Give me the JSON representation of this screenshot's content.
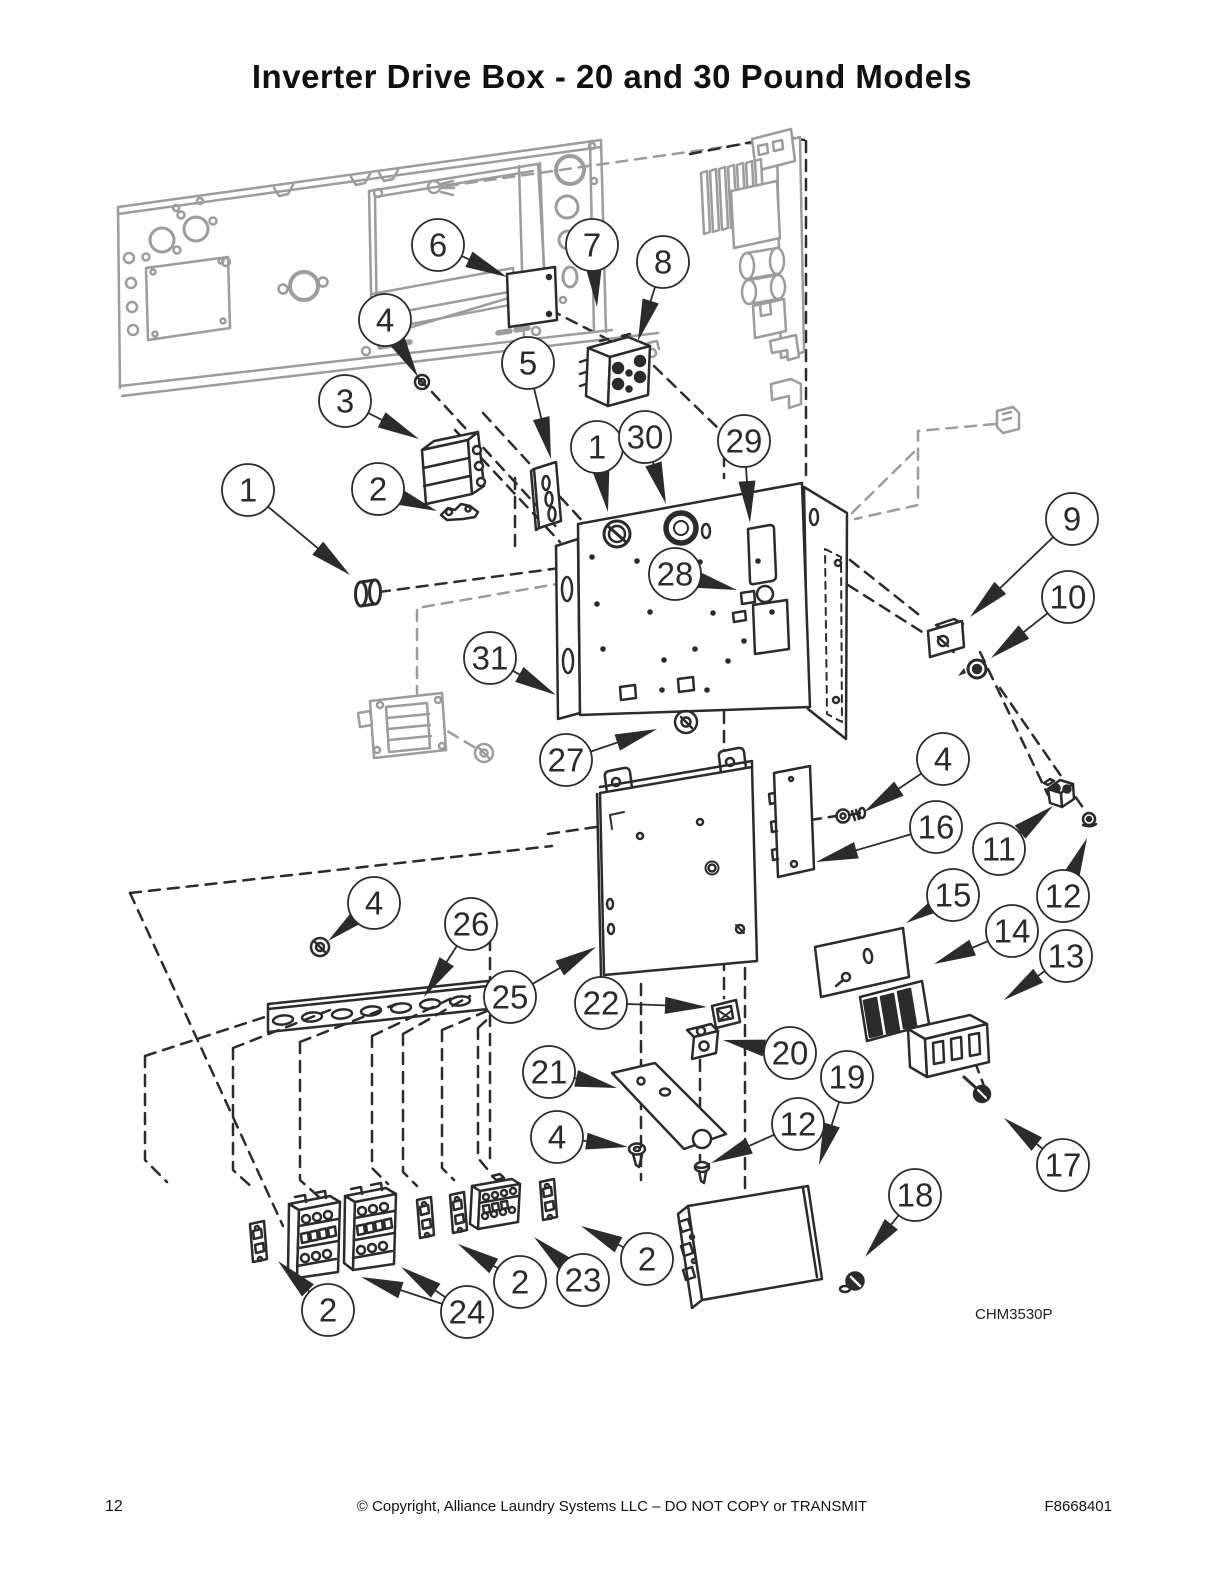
{
  "title": "Inverter Drive Box - 20 and 30 Pound Models",
  "diagram": {
    "figure_code": "CHM3530P",
    "callout_radius": 26,
    "callouts": [
      {
        "n": "6",
        "c": [
          438,
          245
        ],
        "tips": [
          [
            507,
            277
          ]
        ]
      },
      {
        "n": "7",
        "c": [
          592,
          245
        ],
        "tips": [
          [
            597,
            307
          ]
        ]
      },
      {
        "n": "8",
        "c": [
          663,
          262
        ],
        "tips": [
          [
            638,
            341
          ]
        ]
      },
      {
        "n": "4",
        "c": [
          385,
          320
        ],
        "tips": [
          [
            418,
            377
          ]
        ]
      },
      {
        "n": "5",
        "c": [
          528,
          363
        ],
        "tips": [
          [
            551,
            459
          ]
        ]
      },
      {
        "n": "3",
        "c": [
          345,
          401
        ],
        "tips": [
          [
            419,
            439
          ]
        ]
      },
      {
        "n": "1",
        "c": [
          597,
          447
        ],
        "tips": [
          [
            608,
            512
          ]
        ]
      },
      {
        "n": "30",
        "c": [
          645,
          437
        ],
        "tips": [
          [
            666,
            504
          ]
        ]
      },
      {
        "n": "29",
        "c": [
          744,
          441
        ],
        "tips": [
          [
            750,
            523
          ]
        ]
      },
      {
        "n": "2",
        "c": [
          378,
          489
        ],
        "tips": [
          [
            437,
            511
          ]
        ]
      },
      {
        "n": "1",
        "c": [
          248,
          490
        ],
        "tips": [
          [
            350,
            575
          ]
        ]
      },
      {
        "n": "9",
        "c": [
          1072,
          519
        ],
        "tips": [
          [
            970,
            617
          ]
        ]
      },
      {
        "n": "10",
        "c": [
          1068,
          597
        ],
        "tips": [
          [
            991,
            658
          ]
        ]
      },
      {
        "n": "28",
        "c": [
          675,
          574
        ],
        "tips": [
          [
            737,
            590
          ]
        ]
      },
      {
        "n": "31",
        "c": [
          490,
          658
        ],
        "tips": [
          [
            556,
            695
          ]
        ]
      },
      {
        "n": "27",
        "c": [
          566,
          760
        ],
        "tips": [
          [
            657,
            729
          ]
        ]
      },
      {
        "n": "4",
        "c": [
          943,
          759
        ],
        "tips": [
          [
            864,
            812
          ]
        ]
      },
      {
        "n": "16",
        "c": [
          936,
          827
        ],
        "tips": [
          [
            816,
            862
          ]
        ]
      },
      {
        "n": "11",
        "c": [
          999,
          849
        ],
        "tips": [
          [
            1053,
            806
          ]
        ]
      },
      {
        "n": "12",
        "c": [
          1063,
          896
        ],
        "tips": [
          [
            1087,
            838
          ]
        ]
      },
      {
        "n": "15",
        "c": [
          953,
          895
        ],
        "tips": [
          [
            906,
            923
          ]
        ]
      },
      {
        "n": "14",
        "c": [
          1012,
          931
        ],
        "tips": [
          [
            934,
            964
          ]
        ]
      },
      {
        "n": "13",
        "c": [
          1066,
          956
        ],
        "tips": [
          [
            1004,
            1000
          ]
        ]
      },
      {
        "n": "4",
        "c": [
          374,
          903
        ],
        "tips": [
          [
            328,
            941
          ]
        ]
      },
      {
        "n": "26",
        "c": [
          471,
          924
        ],
        "tips": [
          [
            424,
            997
          ]
        ]
      },
      {
        "n": "25",
        "c": [
          510,
          997
        ],
        "tips": [
          [
            596,
            947
          ]
        ]
      },
      {
        "n": "22",
        "c": [
          601,
          1003
        ],
        "tips": [
          [
            707,
            1007
          ]
        ]
      },
      {
        "n": "20",
        "c": [
          790,
          1053
        ],
        "tips": [
          [
            723,
            1040
          ]
        ]
      },
      {
        "n": "21",
        "c": [
          549,
          1072
        ],
        "tips": [
          [
            617,
            1088
          ]
        ]
      },
      {
        "n": "19",
        "c": [
          847,
          1077
        ],
        "tips": [
          [
            819,
            1165
          ]
        ]
      },
      {
        "n": "4",
        "c": [
          557,
          1137
        ],
        "tips": [
          [
            628,
            1147
          ]
        ]
      },
      {
        "n": "12",
        "c": [
          798,
          1124
        ],
        "tips": [
          [
            711,
            1163
          ]
        ]
      },
      {
        "n": "17",
        "c": [
          1063,
          1165
        ],
        "tips": [
          [
            1004,
            1118
          ]
        ]
      },
      {
        "n": "18",
        "c": [
          915,
          1195
        ],
        "tips": [
          [
            865,
            1257
          ]
        ]
      },
      {
        "n": "2",
        "c": [
          647,
          1259
        ],
        "tips": [
          [
            581,
            1226
          ]
        ]
      },
      {
        "n": "23",
        "c": [
          583,
          1280
        ],
        "tips": [
          [
            534,
            1237
          ]
        ]
      },
      {
        "n": "2",
        "c": [
          520,
          1282
        ],
        "tips": [
          [
            458,
            1244
          ]
        ]
      },
      {
        "n": "24",
        "c": [
          467,
          1312
        ],
        "tips": [
          [
            361,
            1277
          ],
          [
            401,
            1267
          ]
        ]
      },
      {
        "n": "2",
        "c": [
          328,
          1310
        ],
        "tips": [
          [
            278,
            1261
          ]
        ]
      }
    ]
  },
  "footer": {
    "page_number": "12",
    "copyright": "© Copyright, Alliance Laundry Systems LLC – DO NOT COPY or TRANSMIT",
    "document_number": "F8668401"
  }
}
